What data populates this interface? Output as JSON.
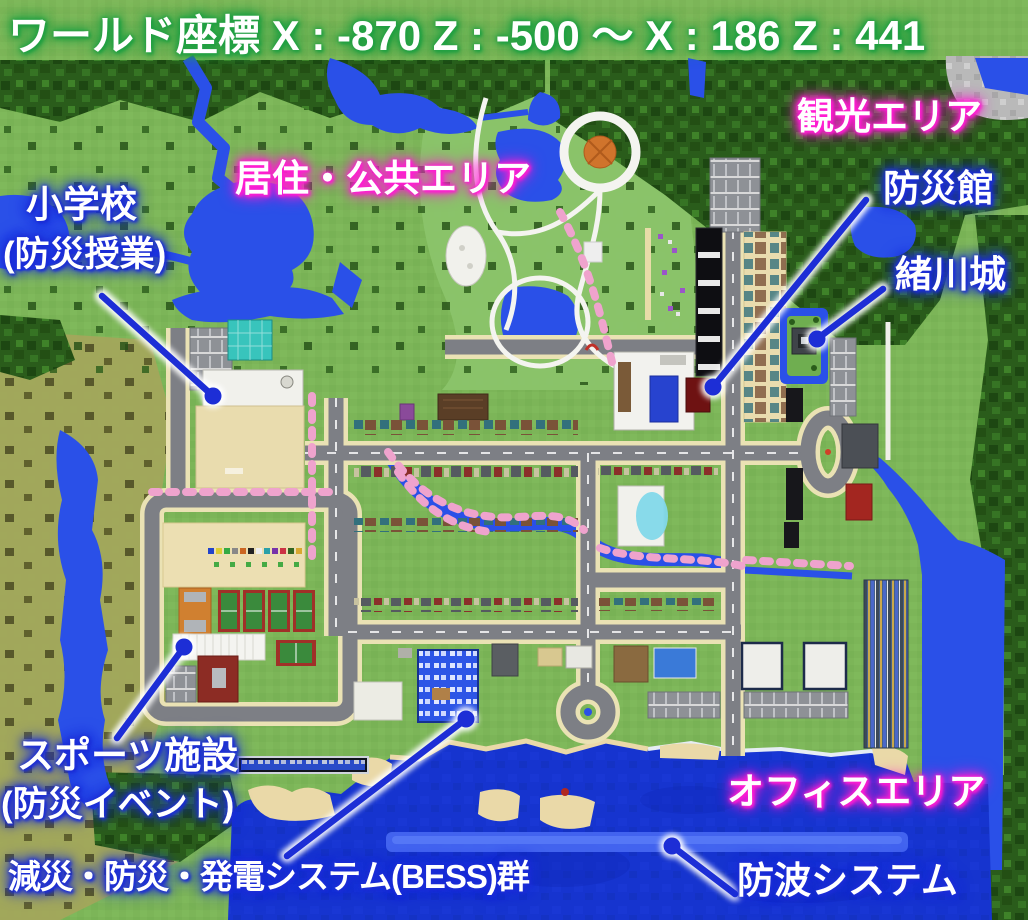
{
  "title": {
    "text": "ワールド座標 X : -870  Z : -500 ～ X : 186 Z : 441",
    "world_coords": {
      "x_min": -870,
      "z_min": -500,
      "x_max": 186,
      "z_max": 441
    }
  },
  "area_labels": {
    "tourism": "観光エリア",
    "residential_public": "居住・公共エリア",
    "office": "オフィスエリア"
  },
  "facility_labels": {
    "school_line1": "小学校",
    "school_line2": "(防災授業)",
    "disaster_hall": "防災館",
    "ogawa_castle": "緒川城",
    "sports_line1": "スポーツ施設",
    "sports_line2": "(防災イベント)",
    "bess_systems": "減災・防災・発電システム(BESS)群",
    "breakwater": "防波システム"
  },
  "colors": {
    "label-text": "#ffffff",
    "glow-area": "#ff1ed2",
    "glow-facility": "#1d2ed6",
    "glow-title": "#22a043",
    "annotation": "#1d2ed6",
    "grass": "#7cb558",
    "forest": "#2a5c1b",
    "water": "#2a50e8",
    "ocean": "#1634cf",
    "breakwater-band": "#4566f0",
    "road": "#7d7f85",
    "sidewalk": "#eae2b4",
    "sand": "#ead9a8",
    "cherry": "#efa3cd"
  }
}
